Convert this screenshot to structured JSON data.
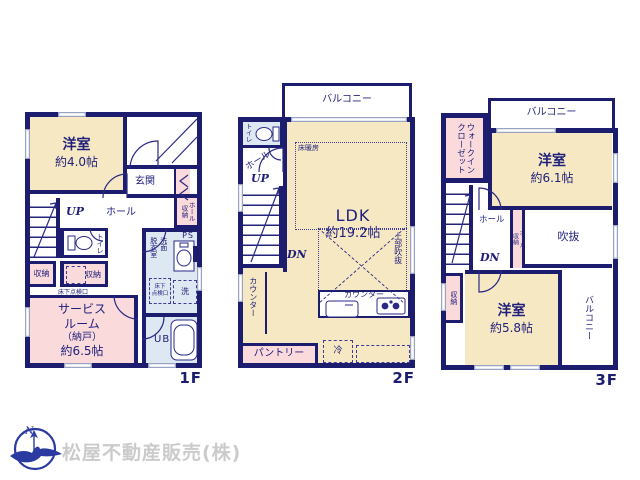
{
  "palette": {
    "wall_navy": "#1d1d70",
    "text_navy": "#20207c",
    "room_cream": "#f7e8c4",
    "room_pink": "#fadadb",
    "room_blue": "#dee8f2",
    "window_gray": "#9aa2c6",
    "company_gray": "#cbcbcb",
    "logo_blue": "#2b3aa0"
  },
  "compass": {
    "north_label": "N"
  },
  "company": {
    "name": "松屋不動産販売(株)"
  },
  "floors": {
    "f1": {
      "label": "1F",
      "rooms": {
        "yoshitsu": {
          "name": "洋室",
          "size": "約4.0帖"
        },
        "genkan": "玄関",
        "hall": "ホール",
        "up": "UP",
        "hall_storage": {
          "col1": "ホール",
          "col2": "収納"
        },
        "toilet": "トイレ",
        "shuno_left": "収納",
        "shuno_right": "収納",
        "underfloor_hatch": "床下点検口",
        "service": {
          "line1": "サービス",
          "line2": "ルーム",
          "line3": "（納戸）",
          "line4": "約6.5帖"
        },
        "datsui": "脱衣室",
        "senmen": "洗面",
        "ps": "PS",
        "underfloor_hatch2": {
          "line1": "床下",
          "line2": "点検口"
        },
        "laundry": "洗",
        "ub": "UB"
      }
    },
    "f2": {
      "label": "2F",
      "rooms": {
        "balcony": "バルコニー",
        "toilet": "トイレ",
        "hall": "ホール",
        "up": "UP",
        "dn": "DN",
        "ldk": {
          "name": "LDK",
          "size": "約19.2帖"
        },
        "floor_heating_1": "床暖房",
        "floor_heating_2": "床暖房",
        "void_above": "上部吹抜",
        "counter_side": "カウンター",
        "counter_kitchen": "カウンター",
        "pantry": "パントリー",
        "fridge": "冷"
      }
    },
    "f3": {
      "label": "3F",
      "rooms": {
        "balcony_top": "バルコニー",
        "wic": {
          "col1": "ウォークイン",
          "col2": "クローゼット"
        },
        "yoshitsu_61": {
          "name": "洋室",
          "size": "約6.1帖"
        },
        "hall": "ホール",
        "dn": "DN",
        "hall_storage": {
          "col1": "ホール",
          "col2": "収納"
        },
        "void": "吹抜",
        "shuno": "収納",
        "yoshitsu_58": {
          "name": "洋室",
          "size": "約5.8帖"
        },
        "balcony_side": "バルコニー"
      }
    }
  }
}
